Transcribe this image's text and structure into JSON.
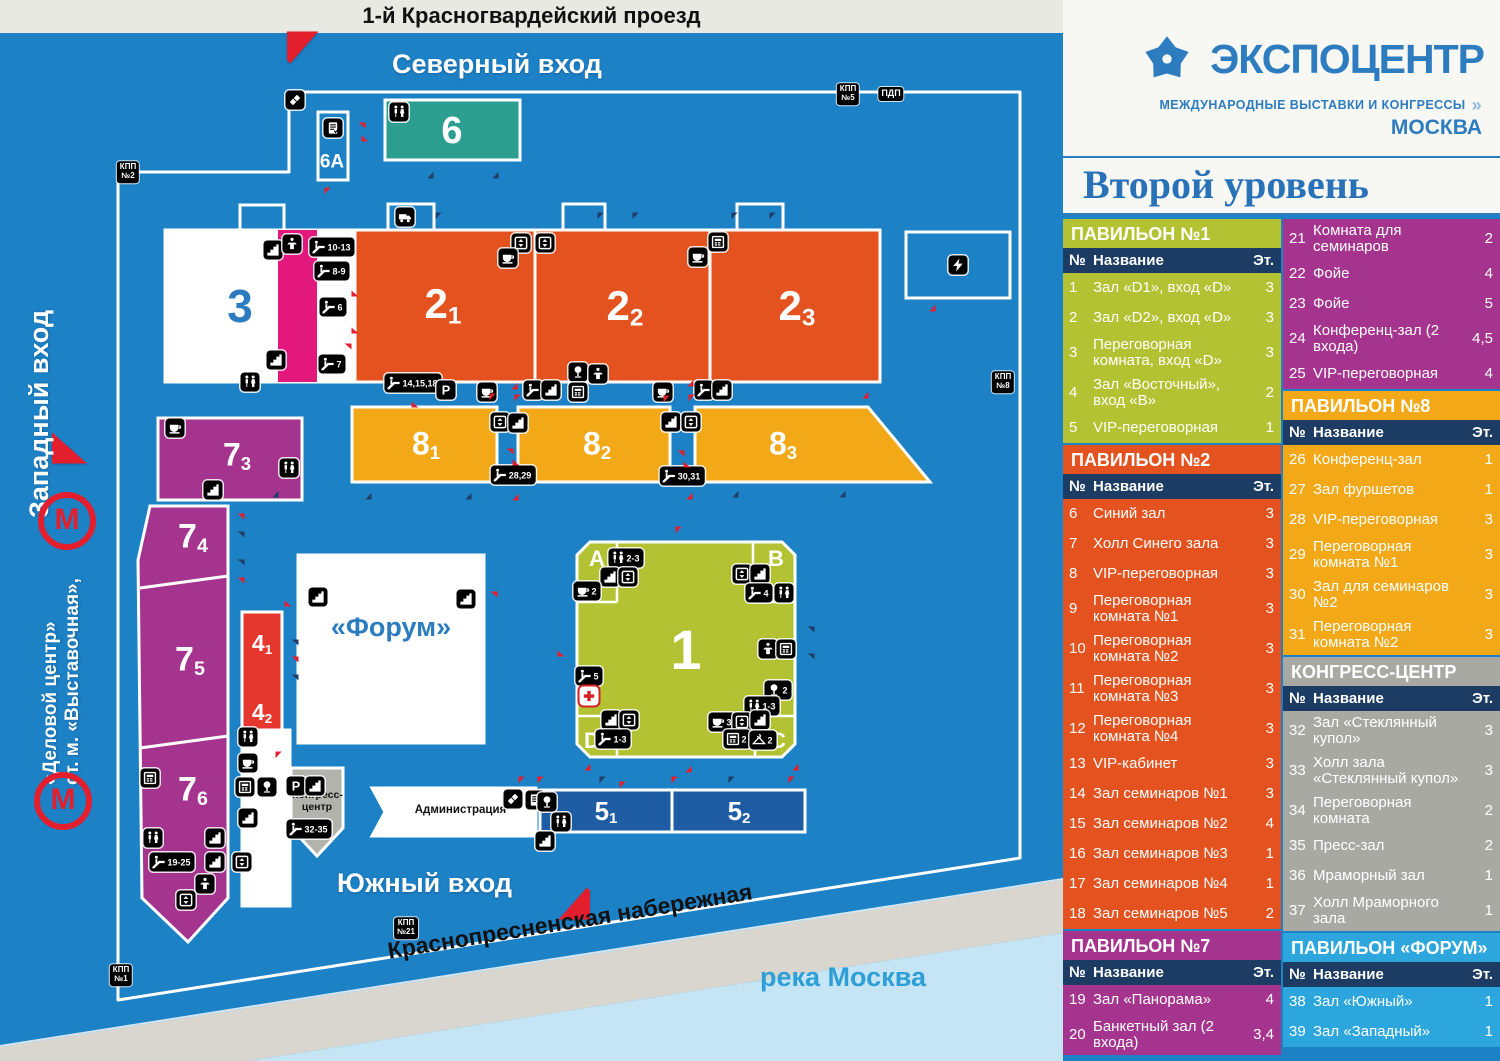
{
  "logo": {
    "name": "ЭКСПОЦЕНТР",
    "tagline": "МЕЖДУНАРОДНЫЕ ВЫСТАВКИ И КОНГРЕССЫ",
    "chevron": "»",
    "city": "МОСКВА"
  },
  "page_title": "Второй уровень",
  "table_columns": {
    "no": "№",
    "name": "Название",
    "floor": "Эт."
  },
  "colors": {
    "map_bg": "#1d81c6",
    "accent_blue": "#2e7cc0",
    "navy_header": "#1c3c63",
    "pav1_green": "#b2c232",
    "pav2_orange": "#e4531f",
    "pav7_purple": "#a5348e",
    "pav8_yellow": "#f3a818",
    "congress_gray": "#a9a9a4",
    "forum_lightblue": "#2ca6dd",
    "building6_teal": "#2d9f90",
    "pink_strip": "#e2187d",
    "building4_red": "#e5372e",
    "building5_blue": "#1e5ca4",
    "arrow_red": "#e31e2d",
    "arrow_navy": "#1e3e66",
    "river": "#c6e5f4",
    "road_gray": "#d8d6cf"
  },
  "sections_left": [
    {
      "id": "pav1",
      "title": "ПАВИЛЬОН №1",
      "color": "#b2c232",
      "rows": [
        [
          "1",
          "Зал «D1», вход «D»",
          "3"
        ],
        [
          "2",
          "Зал «D2», вход «D»",
          "3"
        ],
        [
          "3",
          "Переговорная комната, вход «D»",
          "3"
        ],
        [
          "4",
          "Зал «Восточный», вход «В»",
          "2"
        ],
        [
          "5",
          "VIP-переговорная",
          "1"
        ]
      ]
    },
    {
      "id": "pav2",
      "title": "ПАВИЛЬОН №2",
      "color": "#e4531f",
      "rows": [
        [
          "6",
          "Синий зал",
          "3"
        ],
        [
          "7",
          "Холл Синего зала",
          "3"
        ],
        [
          "8",
          "VIP-переговорная",
          "3"
        ],
        [
          "9",
          "Переговорная комната №1",
          "3"
        ],
        [
          "10",
          "Переговорная комната №2",
          "3"
        ],
        [
          "11",
          "Переговорная комната №3",
          "3"
        ],
        [
          "12",
          "Переговорная комната №4",
          "3"
        ],
        [
          "13",
          "VIP-кабинет",
          "3"
        ],
        [
          "14",
          "Зал семинаров №1",
          "3"
        ],
        [
          "15",
          "Зал семинаров №2",
          "4"
        ],
        [
          "16",
          "Зал семинаров №3",
          "1"
        ],
        [
          "17",
          "Зал семинаров №4",
          "1"
        ],
        [
          "18",
          "Зал семинаров №5",
          "2"
        ]
      ]
    },
    {
      "id": "pav7",
      "title": "ПАВИЛЬОН №7",
      "color": "#a5348e",
      "rows": [
        [
          "19",
          "Зал «Панорама»",
          "4"
        ],
        [
          "20",
          "Банкетный зал (2 входа)",
          "3,4"
        ]
      ]
    }
  ],
  "sections_right": [
    {
      "id": "pav7cont",
      "title": null,
      "color": "#a5348e",
      "rows": [
        [
          "21",
          "Комната для семинаров",
          "2"
        ],
        [
          "22",
          "Фойе",
          "4"
        ],
        [
          "23",
          "Фойе",
          "5"
        ],
        [
          "24",
          "Конференц-зал (2 входа)",
          "4,5"
        ],
        [
          "25",
          "VIP-переговорная",
          "4"
        ]
      ]
    },
    {
      "id": "pav8",
      "title": "ПАВИЛЬОН №8",
      "color": "#f3a818",
      "rows": [
        [
          "26",
          "Конференц-зал",
          "1"
        ],
        [
          "27",
          "Зал фуршетов",
          "1"
        ],
        [
          "28",
          "VIP-переговорная",
          "3"
        ],
        [
          "29",
          "Переговорная комната №1",
          "3"
        ],
        [
          "30",
          "Зал для семинаров №2",
          "3"
        ],
        [
          "31",
          "Переговорная комната №2",
          "3"
        ]
      ]
    },
    {
      "id": "congress",
      "title": "КОНГРЕСС-ЦЕНТР",
      "color": "#a9a9a4",
      "rows": [
        [
          "32",
          "Зал «Стеклянный купол»",
          "3"
        ],
        [
          "33",
          "Холл зала «Стеклянный купол»",
          "3"
        ],
        [
          "34",
          "Переговорная комната",
          "2"
        ],
        [
          "35",
          "Пресс-зал",
          "2"
        ],
        [
          "36",
          "Мраморный зал",
          "1"
        ],
        [
          "37",
          "Холл Мраморного зала",
          "1"
        ]
      ]
    },
    {
      "id": "forum",
      "title": "ПАВИЛЬОН «ФОРУМ»",
      "color": "#2ca6dd",
      "rows": [
        [
          "38",
          "Зал «Южный»",
          "1"
        ],
        [
          "39",
          "Зал «Западный»",
          "1"
        ]
      ]
    }
  ],
  "map": {
    "street_top": "1-й Красногвардейский проезд",
    "embankment": "Краснопресненская набережная",
    "river": "река Москва",
    "north_entrance": "Северный вход",
    "west_entrance": "Западный вход",
    "south_entrance": "Южный вход",
    "metro_line1": "ст. м. «Выставочная»,",
    "metro_line2": "«Деловой центр»",
    "metro_letter": "М",
    "forum": "«Форум»",
    "admin": "Администрация",
    "congress_line1": "Конгресс-",
    "congress_line2": "центр",
    "checkpoints": [
      {
        "x": 128,
        "y": 172,
        "t": "КПП\n№2"
      },
      {
        "x": 848,
        "y": 94,
        "t": "КПП\n№5"
      },
      {
        "x": 891,
        "y": 94,
        "t": "ПДП"
      },
      {
        "x": 1003,
        "y": 382,
        "t": "КПП\n№8"
      },
      {
        "x": 406,
        "y": 928,
        "t": "КПП\n№21"
      },
      {
        "x": 121,
        "y": 975,
        "t": "КПП\n№1"
      }
    ],
    "labels": [
      {
        "t": "6",
        "x": 452,
        "y": 131,
        "fs": 38
      },
      {
        "t": "6A",
        "x": 332,
        "y": 162,
        "fs": 19
      },
      {
        "t": "3",
        "x": 240,
        "y": 306,
        "fs": 46,
        "c": "#2e7cc0"
      },
      {
        "t": "2",
        "s": "1",
        "x": 443,
        "y": 306,
        "fs": 42
      },
      {
        "t": "2",
        "s": "2",
        "x": 625,
        "y": 308,
        "fs": 42
      },
      {
        "t": "2",
        "s": "3",
        "x": 797,
        "y": 308,
        "fs": 42
      },
      {
        "t": "8",
        "s": "1",
        "x": 426,
        "y": 445,
        "fs": 32
      },
      {
        "t": "8",
        "s": "2",
        "x": 597,
        "y": 445,
        "fs": 32
      },
      {
        "t": "8",
        "s": "3",
        "x": 783,
        "y": 445,
        "fs": 32
      },
      {
        "t": "7",
        "s": "3",
        "x": 237,
        "y": 456,
        "fs": 32
      },
      {
        "t": "7",
        "s": "4",
        "x": 193,
        "y": 538,
        "fs": 34
      },
      {
        "t": "7",
        "s": "5",
        "x": 190,
        "y": 661,
        "fs": 34
      },
      {
        "t": "7",
        "s": "6",
        "x": 193,
        "y": 791,
        "fs": 34
      },
      {
        "t": "4",
        "s": "1",
        "x": 262,
        "y": 644,
        "fs": 23
      },
      {
        "t": "4",
        "s": "2",
        "x": 262,
        "y": 713,
        "fs": 23
      },
      {
        "t": "1",
        "x": 686,
        "y": 650,
        "fs": 56
      },
      {
        "t": "5",
        "s": "1",
        "x": 606,
        "y": 812,
        "fs": 26
      },
      {
        "t": "5",
        "s": "2",
        "x": 739,
        "y": 812,
        "fs": 26
      },
      {
        "t": "A",
        "x": 597,
        "y": 559,
        "fs": 22
      },
      {
        "t": "B",
        "x": 776,
        "y": 559,
        "fs": 22
      },
      {
        "t": "C",
        "x": 778,
        "y": 741,
        "fs": 22
      },
      {
        "t": "D",
        "x": 592,
        "y": 741,
        "fs": 22
      }
    ],
    "badges": [
      [
        295,
        100,
        "ticket"
      ],
      [
        333,
        128,
        "reg"
      ],
      [
        399,
        112,
        "wc"
      ],
      [
        273,
        250,
        "stairs"
      ],
      [
        292,
        244,
        "podium"
      ],
      [
        332,
        247,
        "esc",
        "10-13"
      ],
      [
        332,
        271,
        "esc",
        "8-9"
      ],
      [
        333,
        307,
        "esc",
        "6"
      ],
      [
        332,
        364,
        "esc",
        "7"
      ],
      [
        276,
        360,
        "stairs"
      ],
      [
        250,
        382,
        "wc"
      ],
      [
        405,
        217,
        "truck"
      ],
      [
        521,
        243,
        "lift"
      ],
      [
        545,
        243,
        "lift"
      ],
      [
        508,
        258,
        "cup"
      ],
      [
        718,
        242,
        "atm"
      ],
      [
        698,
        257,
        "cup"
      ],
      [
        958,
        265,
        "zap"
      ],
      [
        413,
        383,
        "esc",
        "14,15,18"
      ],
      [
        446,
        390,
        "p"
      ],
      [
        487,
        392,
        "cup"
      ],
      [
        533,
        390,
        "esc"
      ],
      [
        551,
        390,
        "stairs"
      ],
      [
        578,
        372,
        "lamp"
      ],
      [
        598,
        374,
        "podium"
      ],
      [
        578,
        392,
        "atm"
      ],
      [
        663,
        392,
        "cup"
      ],
      [
        704,
        390,
        "esc"
      ],
      [
        722,
        390,
        "stairs"
      ],
      [
        500,
        422,
        "lift"
      ],
      [
        518,
        423,
        "stairs"
      ],
      [
        513,
        475,
        "esc",
        "28,29"
      ],
      [
        671,
        422,
        "stairs"
      ],
      [
        691,
        422,
        "lift"
      ],
      [
        682,
        476,
        "esc",
        "30,31"
      ],
      [
        175,
        428,
        "cup"
      ],
      [
        289,
        468,
        "wc"
      ],
      [
        213,
        490,
        "stairs"
      ],
      [
        150,
        778,
        "atm"
      ],
      [
        153,
        838,
        "wc"
      ],
      [
        215,
        838,
        "stairs"
      ],
      [
        172,
        862,
        "esc",
        "19-25"
      ],
      [
        215,
        862,
        "stairs"
      ],
      [
        242,
        862,
        "lift"
      ],
      [
        205,
        884,
        "podium"
      ],
      [
        186,
        900,
        "lift"
      ],
      [
        248,
        737,
        "wc"
      ],
      [
        248,
        763,
        "cup"
      ],
      [
        245,
        787,
        "atm"
      ],
      [
        267,
        787,
        "lamp"
      ],
      [
        248,
        818,
        "stairs"
      ],
      [
        318,
        597,
        "stairs"
      ],
      [
        466,
        599,
        "stairs"
      ],
      [
        296,
        786,
        "p"
      ],
      [
        315,
        786,
        "stairs"
      ],
      [
        309,
        829,
        "esc",
        "32-35"
      ],
      [
        513,
        799,
        "ticket"
      ],
      [
        535,
        800,
        "reg"
      ],
      [
        547,
        802,
        "lamp"
      ],
      [
        561,
        822,
        "wc"
      ],
      [
        545,
        841,
        "stairs"
      ],
      [
        626,
        558,
        "wc",
        "2-3"
      ],
      [
        610,
        577,
        "stairs"
      ],
      [
        628,
        577,
        "lift"
      ],
      [
        587,
        591,
        "cup",
        "2"
      ],
      [
        742,
        574,
        "lift"
      ],
      [
        760,
        574,
        "stairs"
      ],
      [
        759,
        593,
        "esc",
        "4"
      ],
      [
        784,
        593,
        "wc"
      ],
      [
        589,
        676,
        "esc",
        "5"
      ],
      [
        589,
        696,
        "cross"
      ],
      [
        768,
        649,
        "podium"
      ],
      [
        786,
        649,
        "atm"
      ],
      [
        778,
        690,
        "lamp",
        "2"
      ],
      [
        762,
        706,
        "wc",
        "1-3"
      ],
      [
        611,
        720,
        "stairs"
      ],
      [
        629,
        720,
        "lift"
      ],
      [
        613,
        739,
        "esc",
        "1-3"
      ],
      [
        722,
        722,
        "cup",
        "3"
      ],
      [
        742,
        722,
        "lift"
      ],
      [
        760,
        720,
        "stairs"
      ],
      [
        737,
        739,
        "atm",
        "2"
      ],
      [
        763,
        740,
        "coat",
        "2"
      ]
    ],
    "arrows": [
      [
        357,
        131,
        "l",
        "r"
      ],
      [
        370,
        133,
        "r",
        "r"
      ],
      [
        333,
        196,
        "d",
        "r"
      ],
      [
        425,
        170,
        "u",
        "n"
      ],
      [
        490,
        170,
        "u",
        "n"
      ],
      [
        444,
        221,
        "d",
        "n"
      ],
      [
        606,
        221,
        "d",
        "n"
      ],
      [
        641,
        221,
        "d",
        "n"
      ],
      [
        740,
        221,
        "d",
        "n"
      ],
      [
        778,
        221,
        "d",
        "n"
      ],
      [
        360,
        288,
        "r",
        "r"
      ],
      [
        360,
        325,
        "r",
        "r"
      ],
      [
        343,
        352,
        "l",
        "r"
      ],
      [
        420,
        399,
        "r",
        "r"
      ],
      [
        509,
        381,
        "u",
        "r"
      ],
      [
        685,
        378,
        "u",
        "r"
      ],
      [
        498,
        402,
        "d",
        "r"
      ],
      [
        523,
        403,
        "d",
        "r"
      ],
      [
        672,
        404,
        "d",
        "r"
      ],
      [
        697,
        403,
        "d",
        "r"
      ],
      [
        270,
        489,
        "u",
        "n"
      ],
      [
        363,
        491,
        "u",
        "n"
      ],
      [
        463,
        491,
        "u",
        "n"
      ],
      [
        510,
        492,
        "u",
        "r"
      ],
      [
        730,
        489,
        "u",
        "n"
      ],
      [
        837,
        489,
        "u",
        "n"
      ],
      [
        684,
        491,
        "u",
        "r"
      ],
      [
        860,
        390,
        "u",
        "r"
      ],
      [
        927,
        303,
        "u",
        "r"
      ],
      [
        505,
        457,
        "l",
        "r"
      ],
      [
        521,
        457,
        "r",
        "r"
      ],
      [
        676,
        459,
        "l",
        "r"
      ],
      [
        692,
        459,
        "r",
        "r"
      ],
      [
        236,
        522,
        "l",
        "r"
      ],
      [
        236,
        540,
        "l",
        "n"
      ],
      [
        236,
        568,
        "l",
        "n"
      ],
      [
        236,
        586,
        "l",
        "r"
      ],
      [
        290,
        648,
        "l",
        "n"
      ],
      [
        290,
        665,
        "l",
        "r"
      ],
      [
        290,
        683,
        "l",
        "n"
      ],
      [
        293,
        598,
        "r",
        "r"
      ],
      [
        489,
        600,
        "l",
        "r"
      ],
      [
        284,
        760,
        "d",
        "r"
      ],
      [
        527,
        785,
        "d",
        "r"
      ],
      [
        546,
        785,
        "d",
        "r"
      ],
      [
        608,
        785,
        "d",
        "n"
      ],
      [
        680,
        785,
        "d",
        "r"
      ],
      [
        737,
        785,
        "d",
        "n"
      ],
      [
        797,
        785,
        "d",
        "r"
      ],
      [
        684,
        535,
        "d",
        "r"
      ],
      [
        566,
        648,
        "r",
        "r"
      ],
      [
        806,
        635,
        "l",
        "n"
      ],
      [
        806,
        662,
        "l",
        "n"
      ],
      [
        683,
        764,
        "u",
        "r"
      ],
      [
        582,
        762,
        "u",
        "r"
      ],
      [
        790,
        762,
        "u",
        "r"
      ],
      [
        628,
        790,
        "d",
        "r"
      ]
    ]
  }
}
